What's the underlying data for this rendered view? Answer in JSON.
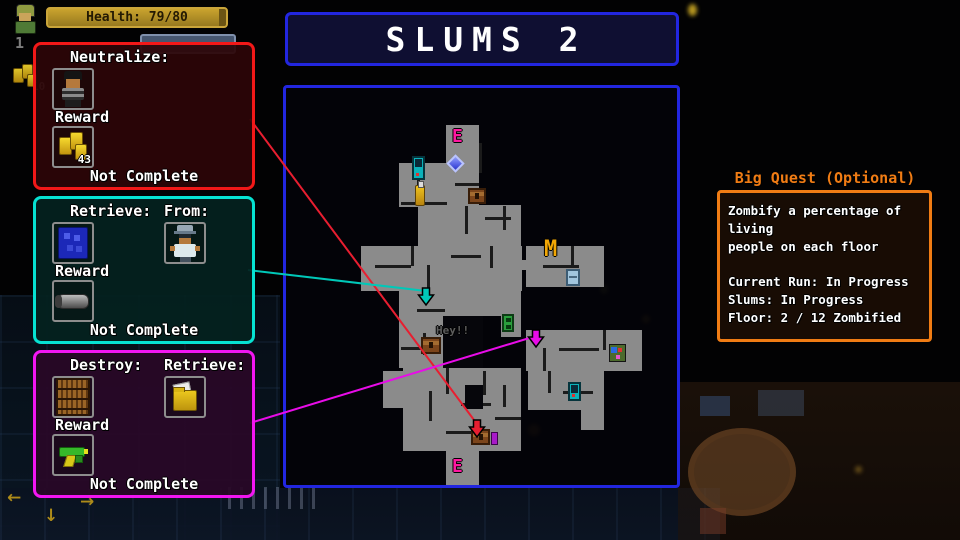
{
  "hud": {
    "health_label": "Health: 79/80",
    "slot_number": "1",
    "coin_count": "10",
    "floor_arrows": {
      "left": "←",
      "down": "↓",
      "right": "→"
    }
  },
  "title": {
    "text": "SLUMS 2"
  },
  "quests": [
    {
      "label1": "Neutralize:",
      "reward_label": "Reward",
      "reward_value": "43",
      "status": "Not Complete",
      "border": "#f21818",
      "bg": "rgba(44,5,8,0.93)"
    },
    {
      "label1": "Retrieve:",
      "label2": "From:",
      "reward_label": "Reward",
      "status": "Not Complete",
      "border": "#06e2d2",
      "bg": "rgba(4,33,31,0.93)"
    },
    {
      "label1": "Destroy:",
      "label2": "Retrieve:",
      "reward_label": "Reward",
      "status": "Not Complete",
      "border": "#f216f2",
      "bg": "rgba(41,7,39,0.93)"
    }
  ],
  "big_quest": {
    "title": "Big Quest (Optional)",
    "body": "Zombify a percentage of living\npeople on each floor\n\nCurrent Run: In Progress\nSlums: In Progress\nFloor: 2 / 12 Zombified",
    "accent": "#f07c14"
  },
  "map": {
    "rooms": [
      [
        160,
        37,
        33,
        82
      ],
      [
        113,
        75,
        48,
        44
      ],
      [
        132,
        117,
        103,
        42
      ],
      [
        75,
        158,
        161,
        45
      ],
      [
        232,
        172,
        12,
        10
      ],
      [
        240,
        158,
        78,
        41
      ],
      [
        113,
        203,
        46,
        77
      ],
      [
        157,
        203,
        78,
        25
      ],
      [
        215,
        225,
        20,
        24
      ],
      [
        240,
        242,
        116,
        41
      ],
      [
        242,
        283,
        76,
        39
      ],
      [
        295,
        322,
        23,
        20
      ],
      [
        117,
        280,
        118,
        83
      ],
      [
        97,
        283,
        20,
        37
      ],
      [
        160,
        363,
        33,
        37
      ]
    ],
    "walls": [
      [
        131,
        77,
        3,
        20
      ],
      [
        115,
        114,
        46,
        3
      ],
      [
        169,
        95,
        24,
        3
      ],
      [
        193,
        55,
        3,
        30
      ],
      [
        179,
        118,
        3,
        28
      ],
      [
        199,
        129,
        26,
        3
      ],
      [
        217,
        118,
        3,
        24
      ],
      [
        89,
        177,
        36,
        3
      ],
      [
        125,
        158,
        3,
        20
      ],
      [
        141,
        177,
        3,
        26
      ],
      [
        165,
        167,
        30,
        3
      ],
      [
        204,
        158,
        3,
        22
      ],
      [
        257,
        177,
        36,
        3
      ],
      [
        285,
        158,
        3,
        20
      ],
      [
        131,
        221,
        28,
        3
      ],
      [
        137,
        245,
        3,
        22
      ],
      [
        115,
        259,
        30,
        3
      ],
      [
        257,
        260,
        3,
        23
      ],
      [
        273,
        260,
        40,
        3
      ],
      [
        317,
        242,
        3,
        20
      ],
      [
        262,
        283,
        3,
        22
      ],
      [
        277,
        303,
        30,
        3
      ],
      [
        143,
        303,
        3,
        30
      ],
      [
        160,
        280,
        3,
        26
      ],
      [
        175,
        315,
        30,
        3
      ],
      [
        197,
        283,
        3,
        24
      ],
      [
        160,
        343,
        36,
        3
      ],
      [
        209,
        329,
        26,
        3
      ],
      [
        217,
        297,
        3,
        22
      ]
    ],
    "darks": [
      [
        157,
        228,
        40,
        52
      ],
      [
        179,
        297,
        18,
        24
      ]
    ],
    "markers": [
      {
        "type": "letter",
        "x": 166,
        "y": 38,
        "text": "E",
        "color": "#ff17a0",
        "fs": 18
      },
      {
        "type": "letter",
        "x": 258,
        "y": 149,
        "text": "M",
        "color": "#f2a705",
        "fs": 22
      },
      {
        "type": "letter",
        "x": 166,
        "y": 368,
        "text": "E",
        "color": "#ff17a0",
        "fs": 18
      },
      {
        "type": "letter",
        "x": 150,
        "y": 236,
        "text": "Hey!!",
        "color": "#5d5d5d",
        "fs": 11
      },
      {
        "type": "vending",
        "x": 126,
        "y": 68,
        "w": 13,
        "h": 24
      },
      {
        "type": "bottle",
        "x": 129,
        "y": 97,
        "w": 10,
        "h": 21
      },
      {
        "type": "chest",
        "x": 182,
        "y": 100,
        "w": 18,
        "h": 16
      },
      {
        "type": "diamond",
        "x": 163,
        "y": 69,
        "w": 13,
        "h": 13
      },
      {
        "type": "fridge",
        "x": 280,
        "y": 181,
        "w": 14,
        "h": 17
      },
      {
        "type": "greenbox",
        "x": 216,
        "y": 226,
        "w": 12,
        "h": 18
      },
      {
        "type": "chest",
        "x": 135,
        "y": 249,
        "w": 20,
        "h": 17
      },
      {
        "type": "arcade",
        "x": 323,
        "y": 256,
        "w": 17,
        "h": 18
      },
      {
        "type": "vending",
        "x": 282,
        "y": 294,
        "w": 13,
        "h": 19
      },
      {
        "type": "chest",
        "x": 185,
        "y": 341,
        "w": 19,
        "h": 16
      },
      {
        "type": "purple",
        "x": 205,
        "y": 344,
        "w": 7,
        "h": 13
      }
    ],
    "lines": [
      {
        "x1": 250,
        "y1": 119,
        "x2": 477,
        "y2": 424,
        "color": "#e81e30",
        "arrow": [
          477,
          420
        ]
      },
      {
        "x1": 248,
        "y1": 270,
        "x2": 426,
        "y2": 291,
        "color": "#00c8b8",
        "arrow": [
          426,
          288
        ]
      },
      {
        "x1": 250,
        "y1": 423,
        "x2": 536,
        "y2": 336,
        "color": "#e80ce8",
        "arrow": [
          536,
          330
        ]
      }
    ]
  }
}
